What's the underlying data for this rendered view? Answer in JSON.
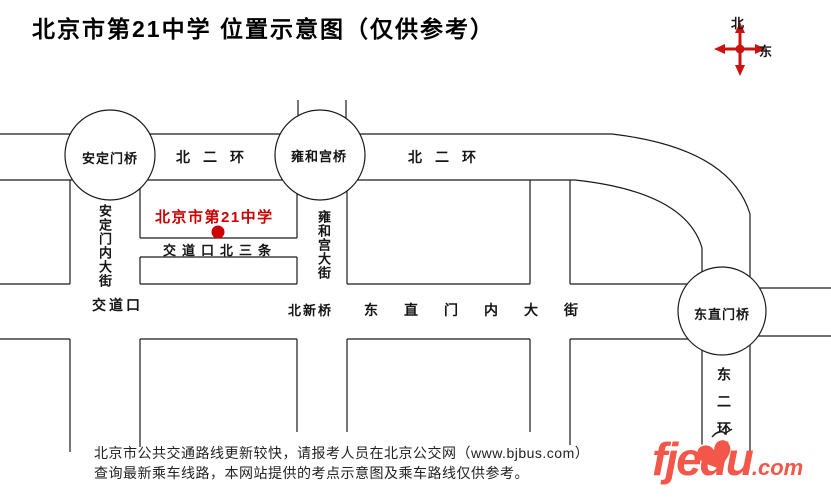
{
  "title": "北京市第21中学 位置示意图（仅供参考）",
  "compass": {
    "north": "北",
    "east": "东"
  },
  "map": {
    "ring_road_labels": {
      "west": "北二环",
      "east": "北二环"
    },
    "bridges": {
      "andingmen": "安定门桥",
      "yonghegong": "雍和宫桥",
      "dongzhimen": "东直门桥"
    },
    "school": {
      "name": "北京市第21中学"
    },
    "streets": {
      "andingmennei": "安定门内大街",
      "jiaodaokou_beisantiao": "交道口北三条",
      "yonghegong_dajie": "雍和宫大街",
      "dongzhimennei_dajie": "东直门内大街",
      "dong_er_huan": "东二环"
    },
    "intersections": {
      "jiaodaokou": "交道口",
      "beixinqiao": "北新桥"
    }
  },
  "footer": {
    "note_line1": "北京市公共交通路线更新较快，请报考人员在北京公交网（www.bjbus.com）",
    "note_line2": "查询最新乘车线路，本网站提供的考点示意图及乘车路线仅供参考。",
    "logo": {
      "text": "fjedu",
      "suffix": ".com"
    }
  },
  "colors": {
    "school_red": "#cc0000",
    "compass_red": "#cc1111",
    "logo_red": "#f25749"
  }
}
